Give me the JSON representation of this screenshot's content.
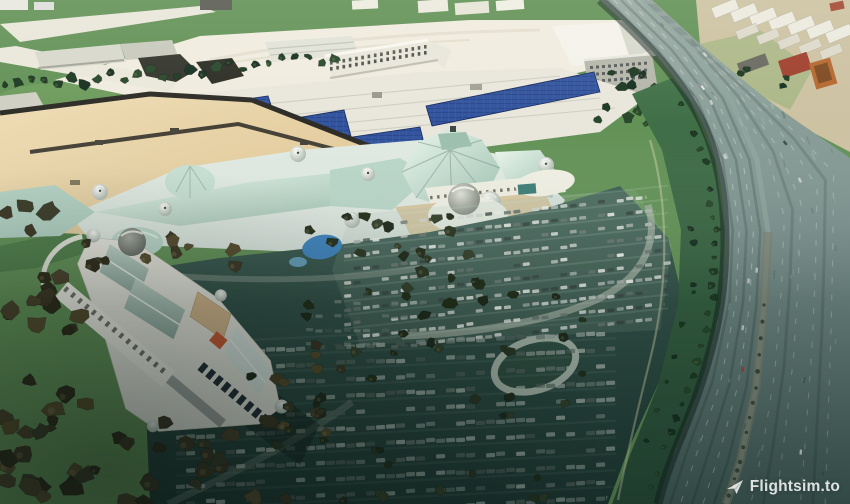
{
  "watermark": {
    "label": "Flightsim.to",
    "icon": "paper-plane-icon",
    "color": "#ffffff"
  },
  "scene": {
    "palette": {
      "grass_green": "#5d8f5a",
      "field_white": "#f0ecdf",
      "mall_roof_teal": "#bcd9cd",
      "parking_deck_tan": "#e8d3a8",
      "solar_panel_blue": "#33549e",
      "parking_shadow_teal": "#2e4f46",
      "highway_asphalt": "#7c928e",
      "tree_olive": "#3a3524",
      "building_white": "#f2f0e6",
      "red_roof": "#a0402e",
      "accent_orange": "#cf5a33",
      "pond_blue": "#3f86c2"
    }
  }
}
